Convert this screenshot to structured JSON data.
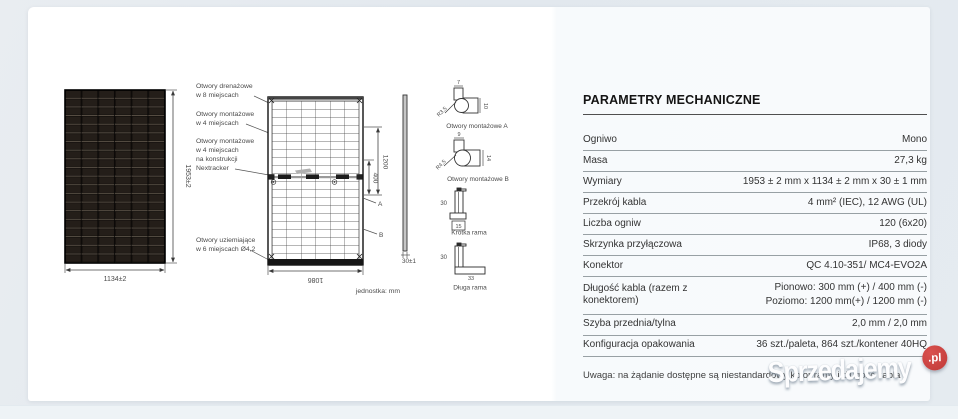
{
  "watermark": {
    "brand": "Sprzedajemy",
    "tld": ".pl",
    "circle_color": "#c7413e"
  },
  "diagram": {
    "unit_note": "jednostka: mm",
    "front": {
      "width": "1134±2",
      "height": "1953±2"
    },
    "rear": {
      "width": "1086",
      "dim_long": "1200",
      "dim_short": "400",
      "point_a": "A",
      "point_b": "B"
    },
    "side": {
      "thickness": "30±1"
    },
    "annotations": {
      "drain_1": "Otwory drenażowe",
      "drain_2": "w 8 miejscach",
      "mount_1": "Otwory montażowe",
      "mount_2": "w 4 miejscach",
      "tracker_1": "Otwory montażowe",
      "tracker_2": "w 4 miejscach",
      "tracker_3": "na konstrukcji",
      "tracker_4": "Nextracker",
      "ground_1": "Otwory uziemiające",
      "ground_2": "w 6 miejscach Ø4,2"
    },
    "details": {
      "hole_a": {
        "label": "Otwory montażowe A",
        "w": "7",
        "h": "10",
        "r": "R3.5"
      },
      "hole_b": {
        "label": "Otwory montażowe B",
        "w": "9",
        "h": "14",
        "r": "R4.5"
      },
      "short_frame": {
        "label": "Krótka rama",
        "h": "30",
        "w": "15"
      },
      "long_frame": {
        "label": "Długa rama",
        "h": "30",
        "w": "33"
      }
    }
  },
  "table": {
    "title": "PARAMETRY MECHANICZNE",
    "rows": [
      {
        "label": "Ogniwo",
        "value": "Mono"
      },
      {
        "label": "Masa",
        "value": "27,3 kg"
      },
      {
        "label": "Wymiary",
        "value": "1953 ± 2 mm x 1134 ± 2 mm x 30 ± 1 mm"
      },
      {
        "label": "Przekrój kabla",
        "value": "4 mm² (IEC), 12 AWG (UL)"
      },
      {
        "label": "Liczba ogniw",
        "value": "120 (6x20)"
      },
      {
        "label": "Skrzynka przyłączowa",
        "value": "IP68, 3 diody"
      },
      {
        "label": "Konektor",
        "value": "QC 4.10-351/ MC4-EVO2A"
      },
      {
        "label": "Długość kabla (razem z konektorem)",
        "value": "Pionowo: 300 mm (+) / 400 mm (-)",
        "value2": "Poziomo: 1200 mm(+) / 1200 mm (-)"
      },
      {
        "label": "Szyba przednia/tylna",
        "value": "2,0 mm / 2,0 mm"
      },
      {
        "label": "Konfiguracja opakowania",
        "value": "36 szt./paleta, 864 szt./kontener 40HQ"
      }
    ],
    "note": "Uwaga: na żądanie dostępne są niestandardowy kolor ramy i długość kabla"
  }
}
